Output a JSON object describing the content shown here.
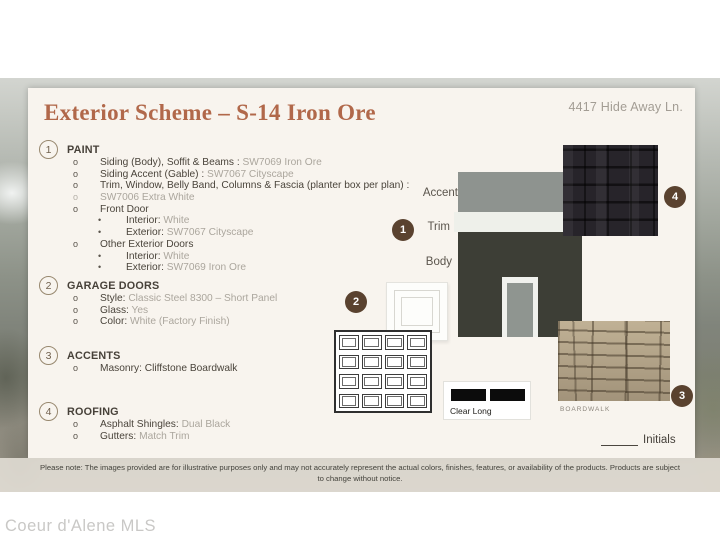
{
  "page": {
    "watermark": "Coeur d'Alene MLS",
    "disclaimer": "Please note: The images provided are for illustrative purposes only and may not accurately represent the actual colors, finishes, features, or availability of the products. Products are subject to change without notice."
  },
  "header": {
    "title": "Exterior Scheme – S-14 Iron Ore",
    "address": "4417 Hide Away Ln."
  },
  "paint": {
    "number": "1",
    "heading": "PAINT",
    "items": [
      {
        "bullet": "o",
        "label": "Siding (Body), Soffit & Beams : ",
        "value": "SW7069 Iron Ore"
      },
      {
        "bullet": "o",
        "label": "Siding Accent (Gable) : ",
        "value": "SW7067 Cityscape"
      },
      {
        "bullet": "o",
        "label": "Trim, Window, Belly Band, Columns & Fascia (planter box per plan) :",
        "value": ""
      },
      {
        "bullet": "o",
        "label": "",
        "value": "SW7006 Extra White"
      },
      {
        "bullet": "o",
        "label": "Front Door",
        "value": ""
      },
      {
        "bullet": "•",
        "label": "Interior: ",
        "value": "White"
      },
      {
        "bullet": "•",
        "label": "Exterior: ",
        "value": "SW7067 Cityscape"
      },
      {
        "bullet": "o",
        "label": "Other Exterior Doors",
        "value": ""
      },
      {
        "bullet": "•",
        "label": "Interior: ",
        "value": "White"
      },
      {
        "bullet": "•",
        "label": "Exterior: ",
        "value": "SW7069 Iron Ore"
      }
    ]
  },
  "garage": {
    "number": "2",
    "heading": "GARAGE DOORS",
    "items": [
      {
        "bullet": "o",
        "label": "Style: ",
        "value": "Classic Steel 8300 – Short Panel"
      },
      {
        "bullet": "o",
        "label": "Glass: ",
        "value": "Yes"
      },
      {
        "bullet": "o",
        "label": "Color: ",
        "value": "White (Factory Finish)"
      }
    ]
  },
  "accents": {
    "number": "3",
    "heading": "ACCENTS",
    "items": [
      {
        "bullet": "o",
        "label": "Masonry: Cliffstone Boardwalk",
        "value": ""
      }
    ]
  },
  "roofing": {
    "number": "4",
    "heading": "ROOFING",
    "items": [
      {
        "bullet": "o",
        "label": "Asphalt Shingles: ",
        "value": "Dual Black"
      },
      {
        "bullet": "o",
        "label": "Gutters: ",
        "value": "Match Trim"
      }
    ]
  },
  "swatches": {
    "accent_label": "Accent",
    "trim_label": "Trim",
    "body_label": "Body",
    "glass_label": "Clear Long",
    "stone_caption": "BOARDWALK",
    "initials_label": "Initials",
    "badges": {
      "paint": "1",
      "garage": "2",
      "masonry": "3",
      "roofing": "4"
    },
    "colors": {
      "accent": "#8e938f",
      "trim": "#eef0ea",
      "body": "#3d3e36",
      "door": "#8f9590",
      "shingle": "#27242a",
      "badge": "#5a422f",
      "title": "#b1684a",
      "card": "#f8f4ee"
    }
  }
}
